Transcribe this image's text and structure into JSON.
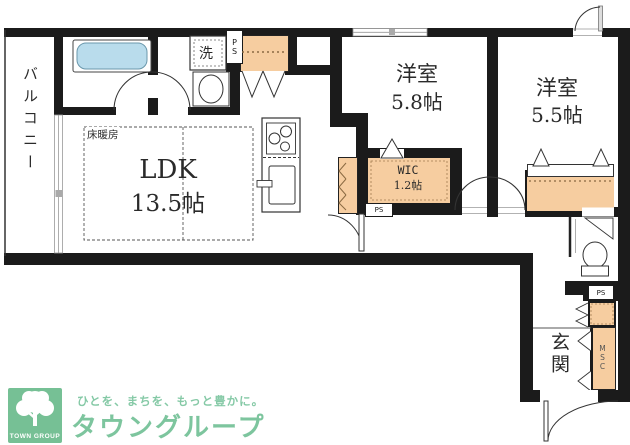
{
  "plan": {
    "balcony": "バルコニー",
    "laundry": "洗",
    "ps": "PS",
    "floor_heating": "床暖房",
    "ldk": {
      "name": "LDK",
      "area": "13.5帖"
    },
    "bedroom1": {
      "name": "洋室",
      "area": "5.8帖"
    },
    "bedroom2": {
      "name": "洋室",
      "area": "5.5帖"
    },
    "wic": {
      "name": "WIC",
      "area": "1.2帖"
    },
    "entrance": "玄関",
    "msc": "MSC"
  },
  "logo": {
    "square_text": "TOWN GROUP",
    "tagline": "ひとを、まちを、もっと豊かに。",
    "brand": "タウングループ"
  },
  "colors": {
    "wall": "#1b1b1b",
    "closet_fill": "#f6cda0",
    "bathtub_fill": "#b9dcec",
    "logo_square_green": "#76c095",
    "logo_text_green": "#7dc59e"
  }
}
